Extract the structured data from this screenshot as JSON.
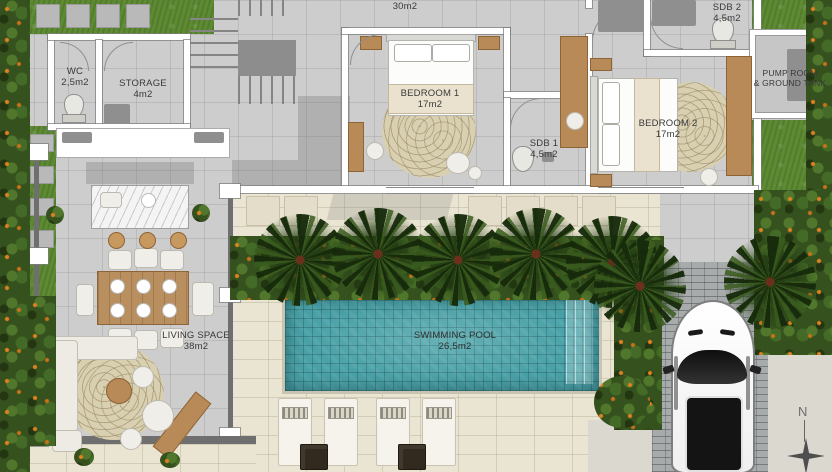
{
  "type": "architectural-floor-plan",
  "rooms": {
    "wc": {
      "name": "WC",
      "area": "2,5m2"
    },
    "storage": {
      "name": "STORAGE",
      "area": "4m2"
    },
    "circulation": {
      "name": "CIRCULATION",
      "area": "30m2"
    },
    "bedroom1": {
      "name": "BEDROOM 1",
      "area": "17m2"
    },
    "sdb1": {
      "name": "SDB 1",
      "area": "4,5m2"
    },
    "sdb2": {
      "name": "SDB 2",
      "area": "4,5m2"
    },
    "bedroom2": {
      "name": "BEDROOM 2",
      "area": "17m2"
    },
    "pump_room": {
      "name": "PUMP ROOM",
      "name2": "& GROUND TANK"
    },
    "living": {
      "name": "LIVING SPACE",
      "area": "38m2"
    },
    "pool": {
      "name": "SWIMMING POOL",
      "area": "26,5m2"
    }
  },
  "compass": {
    "label": "N"
  },
  "colors": {
    "floor_tile": "#cdcdcd",
    "wall": "#ffffff",
    "terrace_deck": "#eae4d3",
    "pool_water": "#4aa2a8",
    "grass": "#5d8a33",
    "foliage": "#35511e",
    "flower_accent": "#e0831f",
    "wood": "#b78a58",
    "driveway_brick": "#a7abab",
    "car_body": "#ffffff"
  }
}
